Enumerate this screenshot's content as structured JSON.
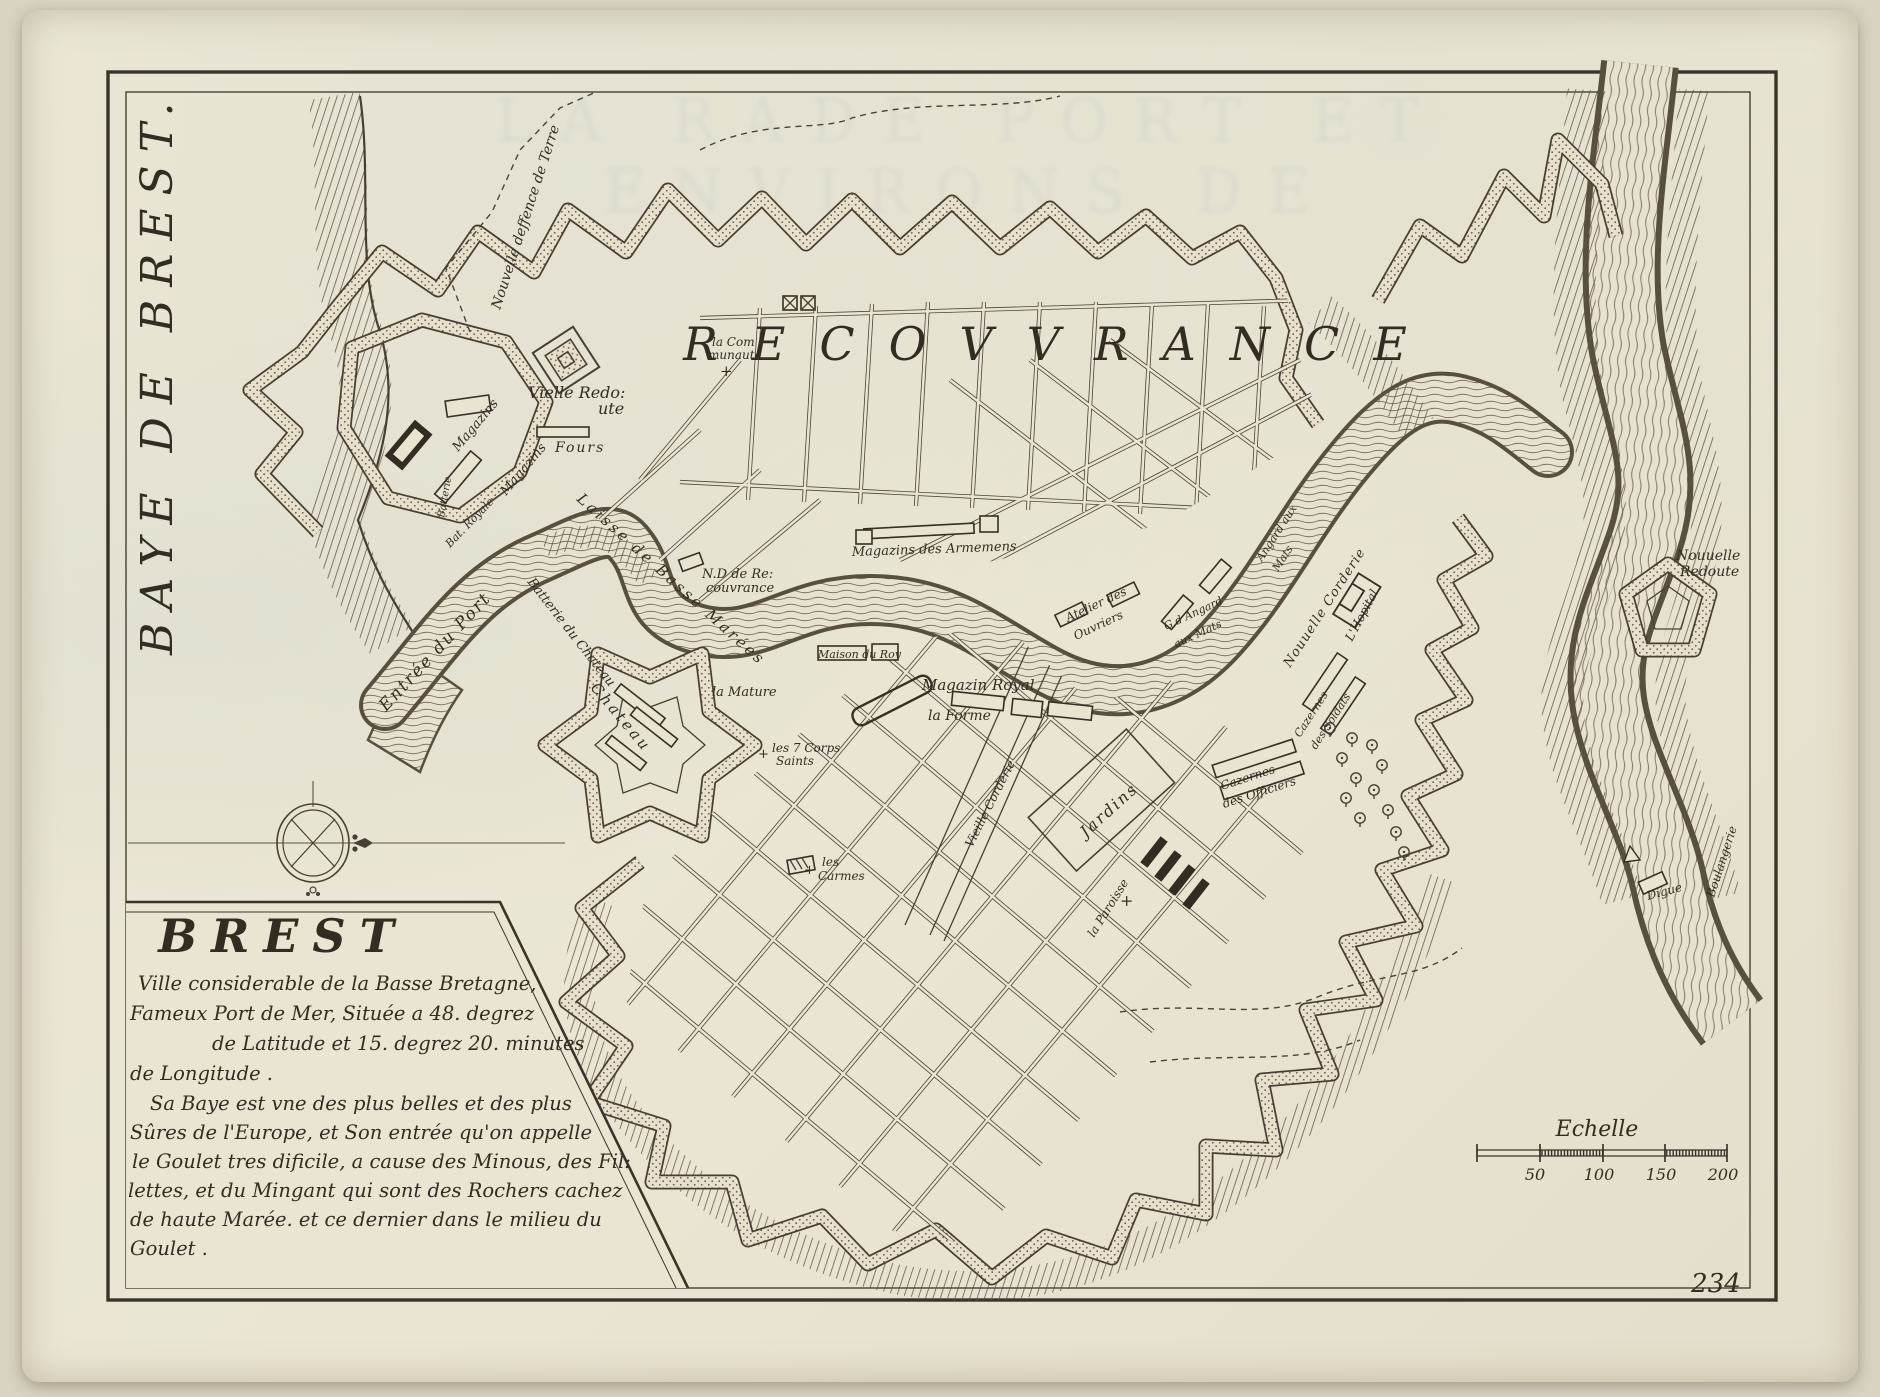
{
  "page": {
    "number": "234"
  },
  "margin": {
    "vertical_title": "BAYE DE BREST."
  },
  "ghost": {
    "title": "LA RADE PORT ET ENVIRONS DE"
  },
  "cartouche": {
    "title": "BREST",
    "p1": [
      "Ville considerable de la Basse Bretagne,",
      "Fameux Port de Mer, Située a 48. degrez",
      "de Latitude et 15. degrez 20. minutes",
      "de Longitude ."
    ],
    "p2": [
      "Sa Baye est vne des plus belles et des plus",
      "Sûres de l'Europe, et Son entrée qu'on appelle",
      "le Goulet tres dificile, a cause des Minous, des Fil:",
      "lettes, et du Mingant qui sont des Rochers cachez",
      "de haute Marée. et ce dernier dans le milieu du",
      "Goulet ."
    ]
  },
  "scale": {
    "label": "Echelle",
    "ticks": [
      "50",
      "100",
      "150",
      "200"
    ]
  },
  "labels": {
    "recouvrance": "RECOVVRANCE",
    "nouvelle_deffence": "Nouvelle deffence de Terre",
    "la_communaute_1": "la Com",
    "la_communaute_2": "munauté",
    "vieille_redoute_1": "Vielle Redo:",
    "vieille_redoute_2": "ute",
    "magazins_a": "Magazins",
    "magazins_b": "Magazins",
    "fours": "Fours",
    "bat_royale": "Bat. Royale",
    "batterie": "Batterie",
    "batterie_du_chateau": "Batterie du Chateau",
    "laisse": "Laisse de Basse Marées",
    "nd_recouvrance_1": "N.D de Re:",
    "nd_recouvrance_2": "couvrance",
    "magazins_armemens": "Magazins des Armemens",
    "atelier_1": "Atelier des",
    "atelier_2": "Ouvriers",
    "gd_angard_1": "G.d Angard",
    "gd_angard_2": "aux Mats",
    "angard_1": "Angard aux",
    "angard_2": "Mats",
    "nouvelle_corderie": "Nouuelle Corderie",
    "hopital": "L'Hopital",
    "caz_soldats_1": "Cazernes",
    "caz_soldats_2": "des Soldats",
    "caz_officiers_1": "Cazernes",
    "caz_officiers_2": "des Officiers",
    "nouvelle_redoute_1": "Nouuelle",
    "nouvelle_redoute_2": "Redoute",
    "entree_du_port": "Entrée du Port",
    "chateau": "Chateau",
    "la_mature": "la Mature",
    "maison_du_roy": "Maison du Roy",
    "magazin_royal": "Magazin Royal",
    "la_forme": "la Forme",
    "corps_saints_1": "les 7 Corps",
    "corps_saints_2": "Saints",
    "les_carmes_1": "les",
    "les_carmes_2": "Carmes",
    "jardins": "Jardins",
    "la_paroisse": "la Paroisse",
    "vieille_corderie": "Vieille Corderie",
    "boulangerie": "Boulangerie",
    "digue": "Digue"
  },
  "colors": {
    "paper": "#eae5d3",
    "ink": "#332c22",
    "water_line": "#7a7160"
  }
}
